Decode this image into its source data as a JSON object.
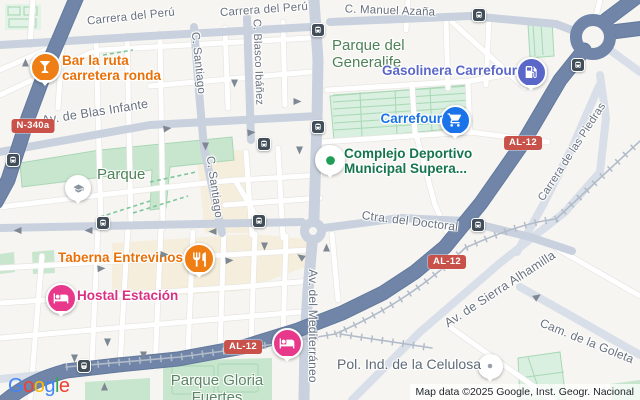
{
  "map": {
    "attribution": "Map data ©2025 Google, Inst. Geogr. Nacional",
    "google_logo": {
      "letters": [
        {
          "ch": "G",
          "color": "#4285F4"
        },
        {
          "ch": "o",
          "color": "#EA4335"
        },
        {
          "ch": "o",
          "color": "#FBBC05"
        },
        {
          "ch": "g",
          "color": "#4285F4"
        },
        {
          "ch": "l",
          "color": "#34A853"
        },
        {
          "ch": "e",
          "color": "#EA4335"
        }
      ]
    },
    "route_badges": [
      {
        "label": "N-340a",
        "x": 33,
        "y": 126
      },
      {
        "label": "AL-12",
        "x": 523,
        "y": 143
      },
      {
        "label": "AL-12",
        "x": 447,
        "y": 262
      },
      {
        "label": "AL-12",
        "x": 243,
        "y": 347
      }
    ],
    "street_labels": [
      {
        "text": "Carrera del Perú",
        "x": 131,
        "y": 17,
        "rot": -6,
        "size": 11.5
      },
      {
        "text": "Carrera del Perú",
        "x": 264,
        "y": 10,
        "rot": -4,
        "size": 11.5
      },
      {
        "text": "C. Manuel Azaña",
        "x": 390,
        "y": 11,
        "rot": 2,
        "size": 11.5
      },
      {
        "text": "C. Santiago",
        "x": 198,
        "y": 63,
        "rot": 84,
        "size": 11.5
      },
      {
        "text": "C. Blasco Ibáñez",
        "x": 258,
        "y": 62,
        "rot": 88,
        "size": 11
      },
      {
        "text": "C. Santiago",
        "x": 214,
        "y": 187,
        "rot": 82,
        "size": 11.5
      },
      {
        "text": "Av. de Blas Infante",
        "x": 95,
        "y": 112,
        "rot": -9,
        "size": 12.5
      },
      {
        "text": "Ctra. del Doctoral",
        "x": 410,
        "y": 221,
        "rot": 7,
        "size": 12
      },
      {
        "text": "Av. del Mediterráneo",
        "x": 313,
        "y": 326,
        "rot": 90,
        "size": 12
      },
      {
        "text": "Carrera de las Piedras",
        "x": 572,
        "y": 152,
        "rot": -57,
        "size": 11
      },
      {
        "text": "Av. de Sierra Alhamilla",
        "x": 500,
        "y": 289,
        "rot": -33,
        "size": 12.5
      },
      {
        "text": "Cam. de la Goleta",
        "x": 587,
        "y": 341,
        "rot": 22,
        "size": 12
      }
    ],
    "area_labels": [
      {
        "id": "parque",
        "lines": [
          "Parque"
        ],
        "x": 97,
        "y": 167,
        "align": "left",
        "size": 15,
        "color": "#4E8157"
      },
      {
        "id": "parque-del-generalife",
        "lines": [
          "Parque del",
          "Generalife"
        ],
        "x": 332,
        "y": 38,
        "align": "left",
        "size": 15,
        "color": "#4E8157"
      },
      {
        "id": "parque-gloria-fuertes",
        "lines": [
          "Parque Gloria",
          "Fuertes"
        ],
        "x": 217,
        "y": 373,
        "align": "center",
        "size": 15,
        "color": "#5C8466"
      }
    ],
    "pois": [
      {
        "id": "bar-la-ruta",
        "icon": "cocktail",
        "pin_color": "#EF7E14",
        "glyph_color": "#FFFFFF",
        "size": 27,
        "x": 45,
        "y": 67,
        "label_lines": [
          "Bar la ruta",
          "carretera ronda"
        ],
        "label_x": 62,
        "label_y": 54,
        "label_align": "left",
        "label_color": "#E8710A",
        "label_size": 13.5
      },
      {
        "id": "taberna-entrevinos",
        "icon": "restaurant",
        "pin_color": "#EF7E14",
        "glyph_color": "#FFFFFF",
        "size": 28,
        "x": 199,
        "y": 259,
        "label_lines": [
          "Taberna Entrevinos"
        ],
        "label_x": 183,
        "label_y": 251,
        "label_align": "right",
        "label_color": "#E8710A",
        "label_size": 13.5
      },
      {
        "id": "hostal-estacion",
        "icon": "bed",
        "pin_color": "#E7388C",
        "glyph_color": "#FFFFFF",
        "size": 27,
        "x": 61,
        "y": 298,
        "label_lines": [
          "Hostal Estación"
        ],
        "label_x": 77,
        "label_y": 289,
        "label_align": "left",
        "label_color": "#D93182",
        "label_size": 13.5
      },
      {
        "id": "hotel-unnamed",
        "icon": "bed",
        "pin_color": "#E7388C",
        "glyph_color": "#FFFFFF",
        "size": 27,
        "x": 287,
        "y": 343,
        "label_lines": []
      },
      {
        "id": "gasolinera-carrefour",
        "icon": "fuel",
        "pin_color": "#5B67C8",
        "glyph_color": "#FFFFFF",
        "size": 27,
        "x": 531,
        "y": 72,
        "label_lines": [
          "Gasolinera Carrefour"
        ],
        "label_x": 517,
        "label_y": 64,
        "label_align": "right",
        "label_color": "#5B67C8",
        "label_size": 13.5
      },
      {
        "id": "carrefour",
        "icon": "cart",
        "pin_color": "#1A73E8",
        "glyph_color": "#FFFFFF",
        "size": 27,
        "x": 455,
        "y": 120,
        "label_lines": [
          "Carrefour"
        ],
        "label_x": 442,
        "label_y": 112,
        "label_align": "right",
        "label_color": "#1A73E8",
        "label_size": 13.5
      },
      {
        "id": "complejo-deportivo",
        "icon": "dot",
        "pin_color": "#FFFFFF",
        "glyph_color": "#1E9E57",
        "size": 26,
        "x": 330,
        "y": 160,
        "label_lines": [
          "Complejo Deportivo",
          "Municipal Supera..."
        ],
        "label_x": 344,
        "label_y": 147,
        "label_align": "left",
        "label_color": "#16754C",
        "label_size": 13.5
      },
      {
        "id": "school",
        "icon": "school",
        "pin_color": "#FFFFFF",
        "glyph_color": "#8A94A1",
        "size": 22,
        "x": 78,
        "y": 188,
        "label_lines": []
      },
      {
        "id": "pol-ind-de-la-celulosa",
        "icon": "dot-small",
        "pin_color": "#FFFFFF",
        "glyph_color": "#98A1AB",
        "size": 21,
        "x": 490,
        "y": 366,
        "label_lines": [
          "Pol. Ind. de la Celulosa"
        ],
        "label_x": 481,
        "label_y": 357,
        "label_align": "right",
        "label_color": "#5E6A76",
        "label_size": 14,
        "label_weight": "normal"
      }
    ],
    "transit_stops": [
      {
        "type": "bus",
        "x": 479,
        "y": 15
      },
      {
        "type": "bus",
        "x": 318,
        "y": 30
      },
      {
        "type": "bus",
        "x": 578,
        "y": 65
      },
      {
        "type": "bus",
        "x": 318,
        "y": 127
      },
      {
        "type": "bus",
        "x": 264,
        "y": 144
      },
      {
        "type": "bus",
        "x": 13,
        "y": 160
      },
      {
        "type": "bus",
        "x": 103,
        "y": 223
      },
      {
        "type": "bus",
        "x": 259,
        "y": 221
      },
      {
        "type": "bus",
        "x": 478,
        "y": 225
      },
      {
        "type": "train",
        "x": 84,
        "y": 366
      }
    ],
    "arrows": [
      {
        "x": 21,
        "y": 58,
        "r": -90
      },
      {
        "x": 230,
        "y": 79,
        "r": 90
      },
      {
        "x": 293,
        "y": 97,
        "r": 0
      },
      {
        "x": 163,
        "y": 124,
        "r": -8
      },
      {
        "x": 247,
        "y": 128,
        "r": -5
      },
      {
        "x": 201,
        "y": 142,
        "r": 90
      },
      {
        "x": 295,
        "y": 146,
        "r": 90
      },
      {
        "x": 13,
        "y": 226,
        "r": 180
      },
      {
        "x": 84,
        "y": 226,
        "r": 180
      },
      {
        "x": 208,
        "y": 227,
        "r": 180
      },
      {
        "x": 97,
        "y": 264,
        "r": -4
      },
      {
        "x": 225,
        "y": 256,
        "r": -4
      },
      {
        "x": 260,
        "y": 242,
        "r": 90
      },
      {
        "x": 160,
        "y": 250,
        "r": 0
      },
      {
        "x": 322,
        "y": 243,
        "r": -90
      },
      {
        "x": 296,
        "y": 252,
        "r": 215
      },
      {
        "x": 70,
        "y": 354,
        "r": 90
      },
      {
        "x": 103,
        "y": 338,
        "r": 90
      },
      {
        "x": 139,
        "y": 351,
        "r": 90
      },
      {
        "x": 100,
        "y": 382,
        "r": -90
      },
      {
        "x": 533,
        "y": 292,
        "r": -35
      }
    ]
  }
}
